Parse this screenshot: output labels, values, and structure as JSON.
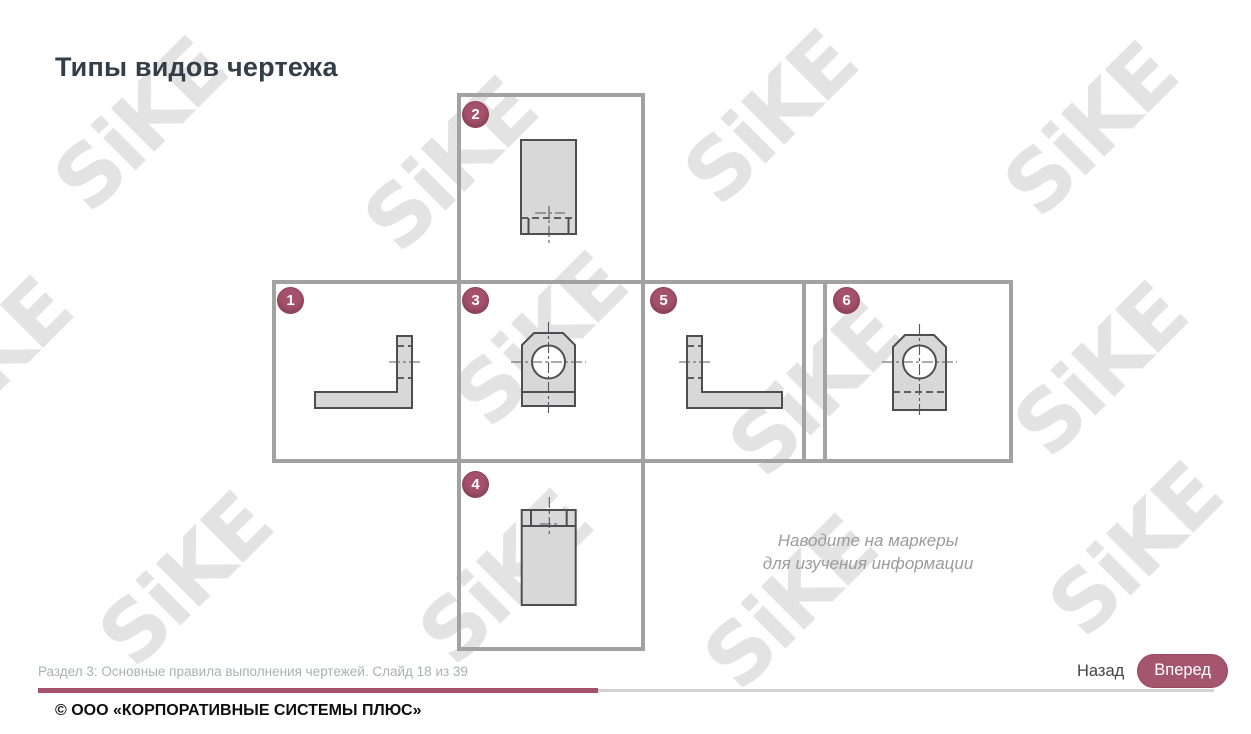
{
  "page": {
    "title": "Типы видов чертежа"
  },
  "watermark": {
    "text": "SiKE"
  },
  "diagram": {
    "hint_line1": "Наводите на маркеры",
    "hint_line2": "для изучения информации",
    "markers": [
      {
        "label": "1"
      },
      {
        "label": "2"
      },
      {
        "label": "3"
      },
      {
        "label": "4"
      },
      {
        "label": "5"
      },
      {
        "label": "6"
      }
    ]
  },
  "footer": {
    "status": "Раздел 3: Основные правила выполнения чертежей. Слайд 18 из 39",
    "back_label": "Назад",
    "next_label": "Вперед",
    "progress_percent": 46,
    "copyright": "© ООО «КОРПОРАТИВНЫЕ СИСТЕМЫ ПЛЮС»"
  },
  "colors": {
    "accent": "#a5516c",
    "box_border": "#a2a2a2",
    "drawing_fill": "#d8d8d8",
    "drawing_stroke": "#4e4e50"
  }
}
